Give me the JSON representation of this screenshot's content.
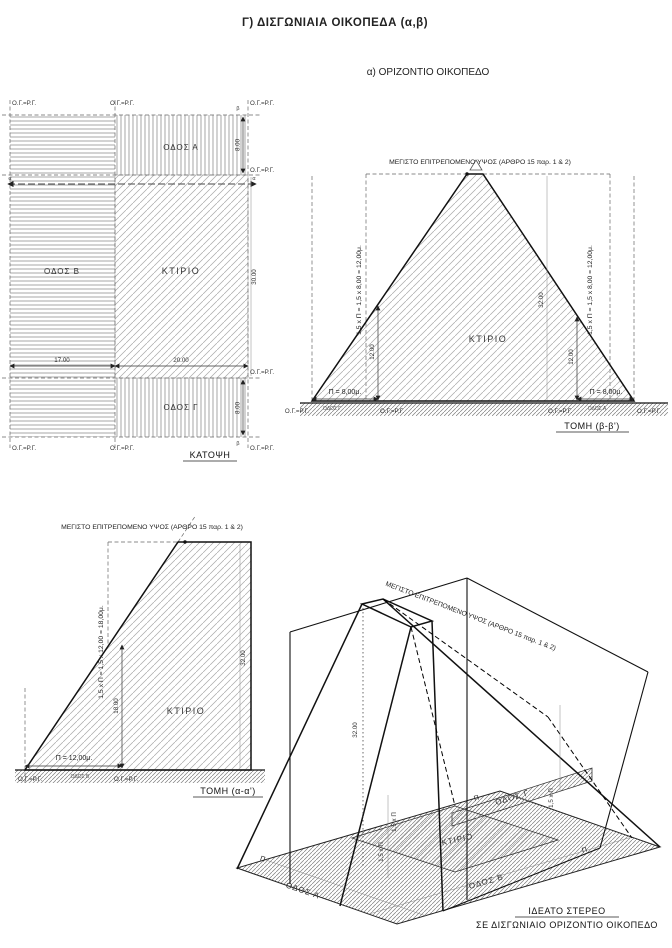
{
  "page": {
    "title": "Γ) ΔΙΣΓΩΝΙΑΙΑ ΟΙΚΟΠΕΔΑ (α,β)",
    "subtitle": "α) ΟΡΙΖΟΝΤΙΟ ΟΙΚΟΠΕΔΟ"
  },
  "labels": {
    "boundary": "Ο.Γ.=Ρ.Γ.",
    "building": "ΚΤΙΡΙΟ",
    "max_height": "ΜΕΓΙΣΤΟ ΕΠΙΤΡΕΠΟΜΕΝΟ ΥΨΟΣ (ΑΡΘΡΟ 15 παρ. 1 & 2)",
    "road_a": "ΟΔΟΣ Α",
    "road_b": "ΟΔΟΣ Β",
    "road_c": "ΟΔΟΣ Γ",
    "pi": "Π",
    "pi_15": "1,5 x Π"
  },
  "plan": {
    "caption": "ΚΑΤΟΨΗ",
    "marker_alpha": "α",
    "marker_beta": "β",
    "dims": {
      "road_a": "8.00",
      "road_c": "8.00",
      "left": "17.00",
      "right": "20.00",
      "depth": "30.00"
    }
  },
  "section_bb": {
    "caption": "ΤΟΜΗ (β-β')",
    "formula": "1,5 x Π = 1,5 x 8,00 = 12,00μ.",
    "p": "Π = 8,00μ.",
    "h_inner": "12.00",
    "h_total": "32.00"
  },
  "section_aa": {
    "caption": "ΤΟΜΗ (α-α')",
    "formula": "1,5 x Π = 1,5 x 12,00 = 18,00μ.",
    "p": "Π = 12,00μ.",
    "h_inner": "18.00",
    "h_total": "32.00"
  },
  "axon": {
    "caption1": "ΙΔΕΑΤΟ ΣΤΕΡΕΟ",
    "caption2": "ΣΕ ΔΙΣΓΩΝΙΑΙΟ ΟΡΙΖΟΝΤΙΟ ΟΙΚΟΠΕΔΟ",
    "h_total": "32.00"
  }
}
